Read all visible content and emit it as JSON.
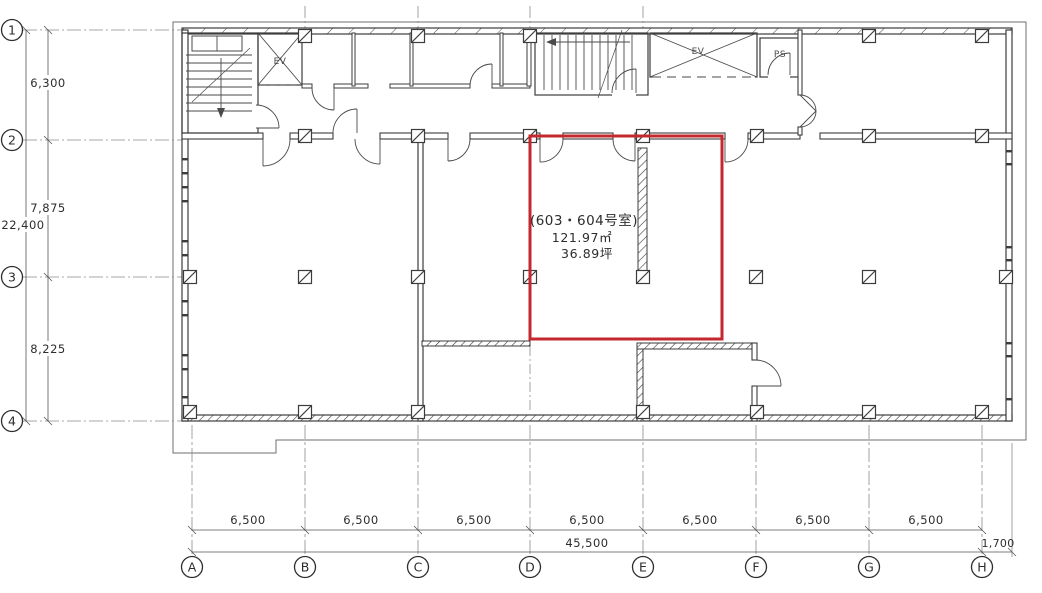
{
  "plan": {
    "grid": {
      "rows": [
        "1",
        "2",
        "3",
        "4"
      ],
      "cols": [
        "A",
        "B",
        "C",
        "D",
        "E",
        "F",
        "G",
        "H"
      ]
    },
    "dims": {
      "left": {
        "segments": [
          "6,300",
          "7,875",
          "8,225"
        ],
        "total": "22,400"
      },
      "bottom": {
        "segments": [
          "6,500",
          "6,500",
          "6,500",
          "6,500",
          "6,500",
          "6,500",
          "6,500"
        ],
        "total": "45,500",
        "right_offset": "1,700"
      }
    },
    "room": {
      "name": "(603・604号室)",
      "area_m2": "121.97㎡",
      "area_tsubo": "36.89坪"
    },
    "labels": {
      "elevator": "EV",
      "pipe_shaft": "PS"
    },
    "colors": {
      "highlight": "#c4272e",
      "line": "#3c3c3c"
    }
  }
}
